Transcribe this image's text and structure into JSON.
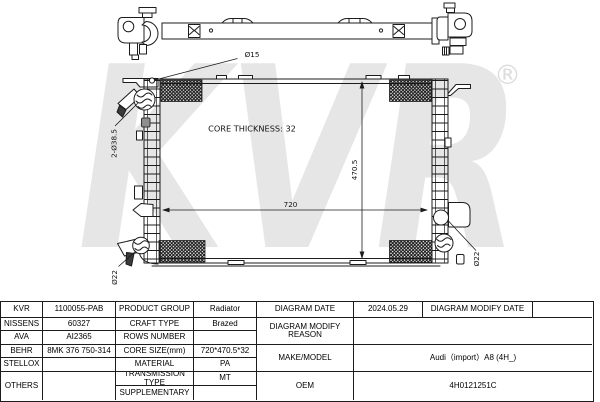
{
  "drawing": {
    "core_thickness_label": "CORE THICKNESS: 32",
    "width_dim": "720",
    "height_dim": "470.5",
    "top_hole_dim": "Ø15",
    "left_ports_dim": "2-Ø38.5",
    "bottom_left_port_dim": "Ø22",
    "bottom_right_port_dim": "Ø22",
    "watermark_text": "KVR",
    "watermark_registered": "®",
    "watermark_color": "#e6e6e6",
    "line_color": "#1c1c1c"
  },
  "table": {
    "brands": [
      {
        "name": "KVR",
        "code": "1100055-PAB"
      },
      {
        "name": "NISSENS",
        "code": "60327"
      },
      {
        "name": "AVA",
        "code": "AI2365"
      },
      {
        "name": "BEHR",
        "code": "8MK 376 750-314"
      },
      {
        "name": "STELLOX",
        "code": ""
      },
      {
        "name": "OTHERS",
        "code": ""
      }
    ],
    "attributes": [
      {
        "label": "PRODUCT GROUP",
        "value": "Radiator"
      },
      {
        "label": "CRAFT TYPE",
        "value": "Brazed"
      },
      {
        "label": "ROWS NUMBER",
        "value": ""
      },
      {
        "label": "CORE SIZE(mm)",
        "value": "720*470.5*32"
      },
      {
        "label": "MATERIAL",
        "value": "PA"
      },
      {
        "label": "TRANSMISSION TYPE",
        "value": "MT"
      },
      {
        "label": "SUPPLEMENTARY",
        "value": ""
      }
    ],
    "right": {
      "diagram_date_label": "DIAGRAM DATE",
      "diagram_date_value": "2024.05.29",
      "diagram_modify_date_label": "DIAGRAM MODIFY DATE",
      "diagram_modify_date_value": "",
      "diagram_modify_reason_label": "DIAGRAM MODIFY REASON",
      "diagram_modify_reason_value": "",
      "make_model_label": "MAKE/MODEL",
      "make_model_value": "Audi（import）A8 (4H_)",
      "oem_label": "OEM",
      "oem_value": "4H0121251C"
    }
  }
}
